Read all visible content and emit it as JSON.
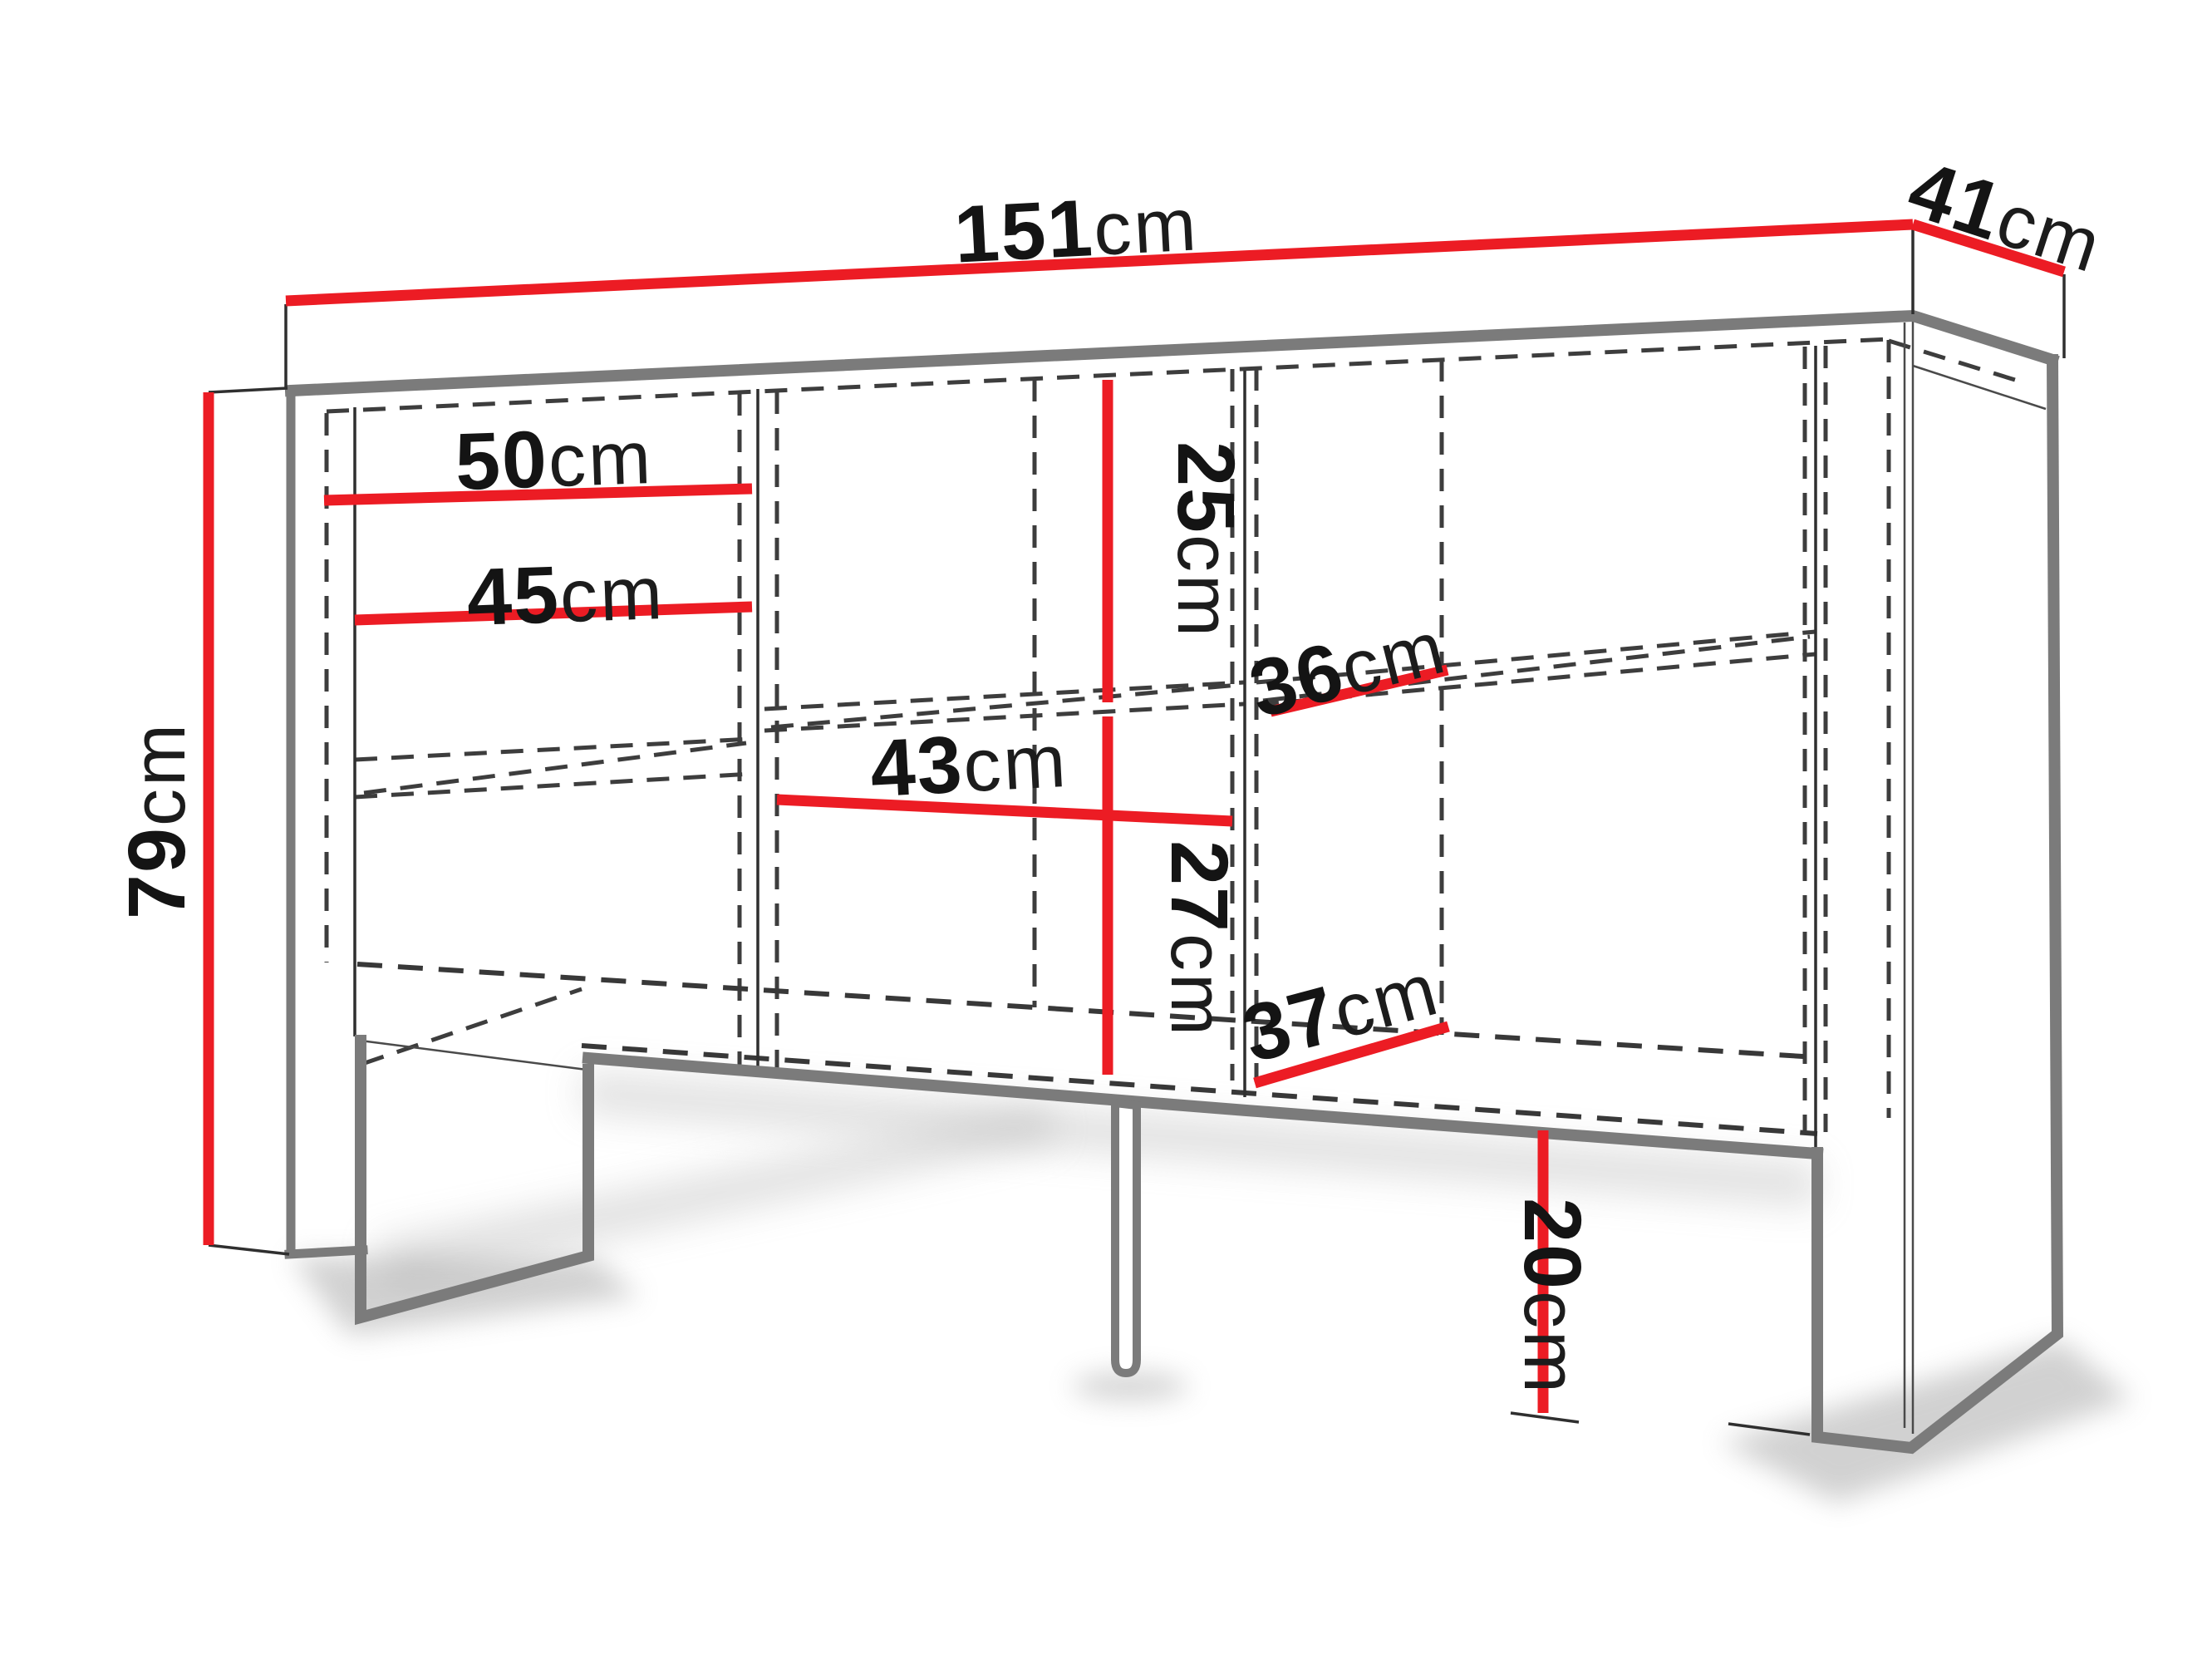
{
  "figure": {
    "type": "furniture-dimension-diagram",
    "subject": "sideboard-cabinet-with-legs",
    "background": "#ffffff"
  },
  "colors": {
    "dimension_line_red": "#ec1c24",
    "cabinet_outline_gray": "#7b7b7b",
    "hidden_edge_dash_gray": "#3d3d3d",
    "label_black": "#141414"
  },
  "dimensions": {
    "overall_width": {
      "num": "151",
      "unit": "cm"
    },
    "overall_depth": {
      "num": "41",
      "unit": "cm"
    },
    "overall_height": {
      "num": "79",
      "unit": "cm"
    },
    "left_section_width": {
      "num": "50",
      "unit": "cm"
    },
    "left_opening_width": {
      "num": "45",
      "unit": "cm"
    },
    "upper_inner_height": {
      "num": "25",
      "unit": "cm"
    },
    "middle_opening_width": {
      "num": "43",
      "unit": "cm"
    },
    "lower_inner_height": {
      "num": "27",
      "unit": "cm"
    },
    "upper_shelf_depth": {
      "num": "36",
      "unit": "cm"
    },
    "lower_shelf_depth": {
      "num": "37",
      "unit": "cm"
    },
    "leg_height": {
      "num": "20",
      "unit": "cm"
    }
  }
}
